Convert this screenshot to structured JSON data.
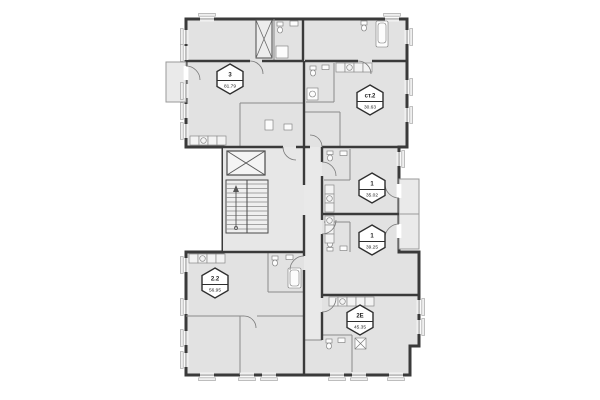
{
  "floor_plan": {
    "units": [
      {
        "id": "unit-3",
        "type": "3",
        "area": "81.79"
      },
      {
        "id": "unit-st-2",
        "type": "ст.2",
        "area": "30.63"
      },
      {
        "id": "unit-1-upper",
        "type": "1",
        "area": "35.02"
      },
      {
        "id": "unit-1-lower",
        "type": "1",
        "area": "39.25"
      },
      {
        "id": "unit-2-2",
        "type": "2.2",
        "area": "56.95"
      },
      {
        "id": "unit-2e",
        "type": "2Е",
        "area": "45.35"
      }
    ],
    "colors": {
      "background": "#ffffff",
      "floor_fill": "#e2e2e2",
      "wall": "#3a3a3a",
      "partition": "#8a8a8a",
      "badge_fill": "#ffffff",
      "badge_stroke": "#2e2e2e"
    },
    "icons": [
      "elevator-icon",
      "staircase-icon",
      "toilet-icon",
      "sink-icon",
      "bathtub-icon",
      "stove-icon",
      "washer-icon",
      "window-icon",
      "door-swing-icon"
    ]
  }
}
